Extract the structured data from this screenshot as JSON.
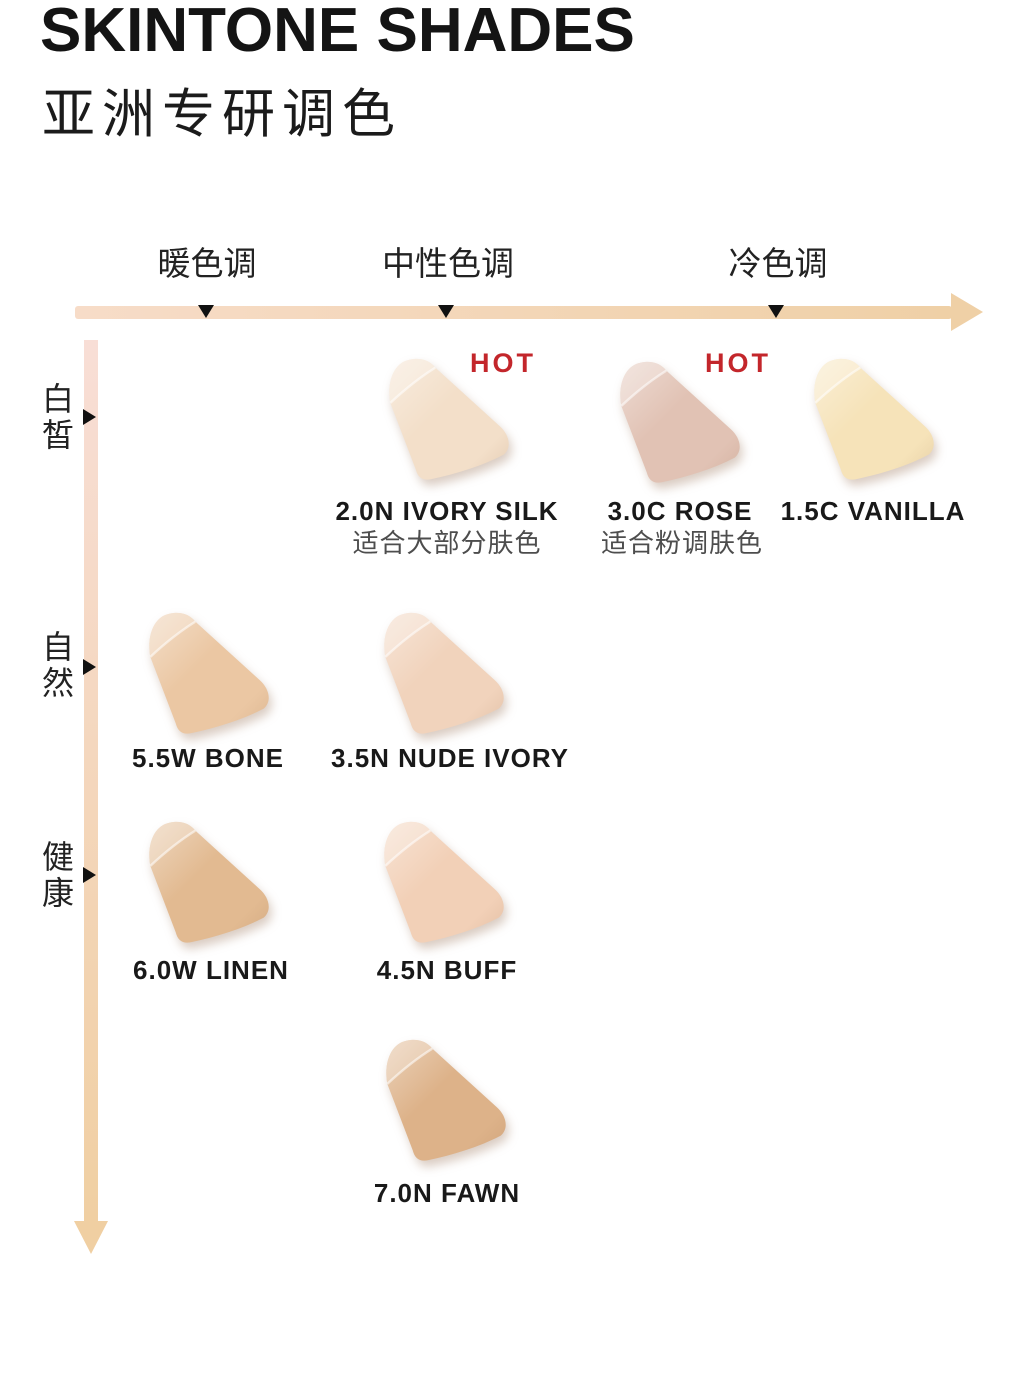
{
  "header": {
    "title": "SKINTONE SHADES",
    "subtitle": "亚洲专研调色"
  },
  "labels": {
    "hot_badge": "HOT"
  },
  "colors": {
    "hot": "#C3262B",
    "shade_name_text": "#191919",
    "note_text": "#4D4D4D",
    "axis_x_left": "#F7DCC8",
    "axis_x_right": "#EFD0A6",
    "axis_y_top": "#F8DED6",
    "axis_y_bottom": "#F0CFA2",
    "tick": "#111111"
  },
  "chart_data": {
    "type": "scatter",
    "title": "SKINTONE SHADES",
    "subtitle": "亚洲专研调色",
    "x_categories": [
      "暖色调",
      "中性色调",
      "冷色调"
    ],
    "y_categories": [
      "白皙",
      "自然",
      "健康"
    ],
    "x_axis_direction": "arrow pointing right, 暖色调 → 冷色调",
    "y_axis_direction": "arrow pointing down, 白皙 → deeper",
    "grid": false,
    "legend": false,
    "points": [
      {
        "name": "2.0N IVORY SILK",
        "x": "中性色调",
        "y": "白皙",
        "row": 1,
        "hot": true,
        "note": "适合大部分肤色",
        "color": "#F3DFC9"
      },
      {
        "name": "3.0C ROSE",
        "x": "冷色调",
        "y": "白皙",
        "row": 1,
        "hot": true,
        "note": "适合粉调肤色",
        "color": "#E1C2B4"
      },
      {
        "name": "1.5C VANILLA",
        "x": "冷色调",
        "y": "白皙",
        "row": 1,
        "hot": false,
        "note": null,
        "color": "#F6E3B9"
      },
      {
        "name": "5.5W BONE",
        "x": "暖色调",
        "y": "自然",
        "row": 2,
        "hot": false,
        "note": null,
        "color": "#EBC7A3"
      },
      {
        "name": "3.5N NUDE IVORY",
        "x": "中性色调",
        "y": "自然",
        "row": 2,
        "hot": false,
        "note": null,
        "color": "#F1D3BC"
      },
      {
        "name": "6.0W LINEN",
        "x": "暖色调",
        "y": "健康",
        "row": 3,
        "hot": false,
        "note": null,
        "color": "#E2BA91"
      },
      {
        "name": "4.5N BUFF",
        "x": "中性色调",
        "y": "健康",
        "row": 3,
        "hot": false,
        "note": null,
        "color": "#F2D0B7"
      },
      {
        "name": "7.0N FAWN",
        "x": "中性色调",
        "y": null,
        "row": 4,
        "hot": false,
        "note": null,
        "color": "#DDB289"
      }
    ]
  }
}
